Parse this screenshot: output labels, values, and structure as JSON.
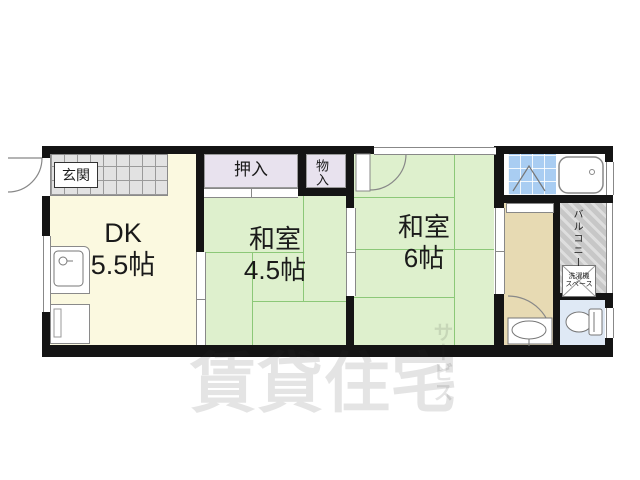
{
  "rooms": {
    "genkan": {
      "label": "玄関"
    },
    "dk": {
      "name": "DK",
      "size": "5.5帖"
    },
    "oshiire": {
      "label": "押入"
    },
    "monoire": {
      "label": "物入"
    },
    "washitsu_45": {
      "name": "和室",
      "size": "4.5帖"
    },
    "washitsu_6": {
      "name": "和室",
      "size": "6帖"
    },
    "balcony": {
      "label": "バルコニー"
    },
    "laundry": {
      "line1": "洗濯機",
      "line2": "スペース"
    }
  },
  "watermark": {
    "main": "賃貸住宅",
    "sub": "サービス"
  },
  "colors": {
    "wall": "#141414",
    "dk_floor": "#fbf9e0",
    "tatami": "#def0cd",
    "tatami_line": "#8cc878",
    "closet": "#e8e2ee",
    "bath_tile": "#a9cdf2",
    "corridor": "#e7dab3",
    "toilet_room": "#dfe9f5",
    "balcony_floor": "#c7c7c7",
    "genkan_tile": "#e2e2e2",
    "watermark_color": "rgba(50,50,50,0.13)"
  }
}
